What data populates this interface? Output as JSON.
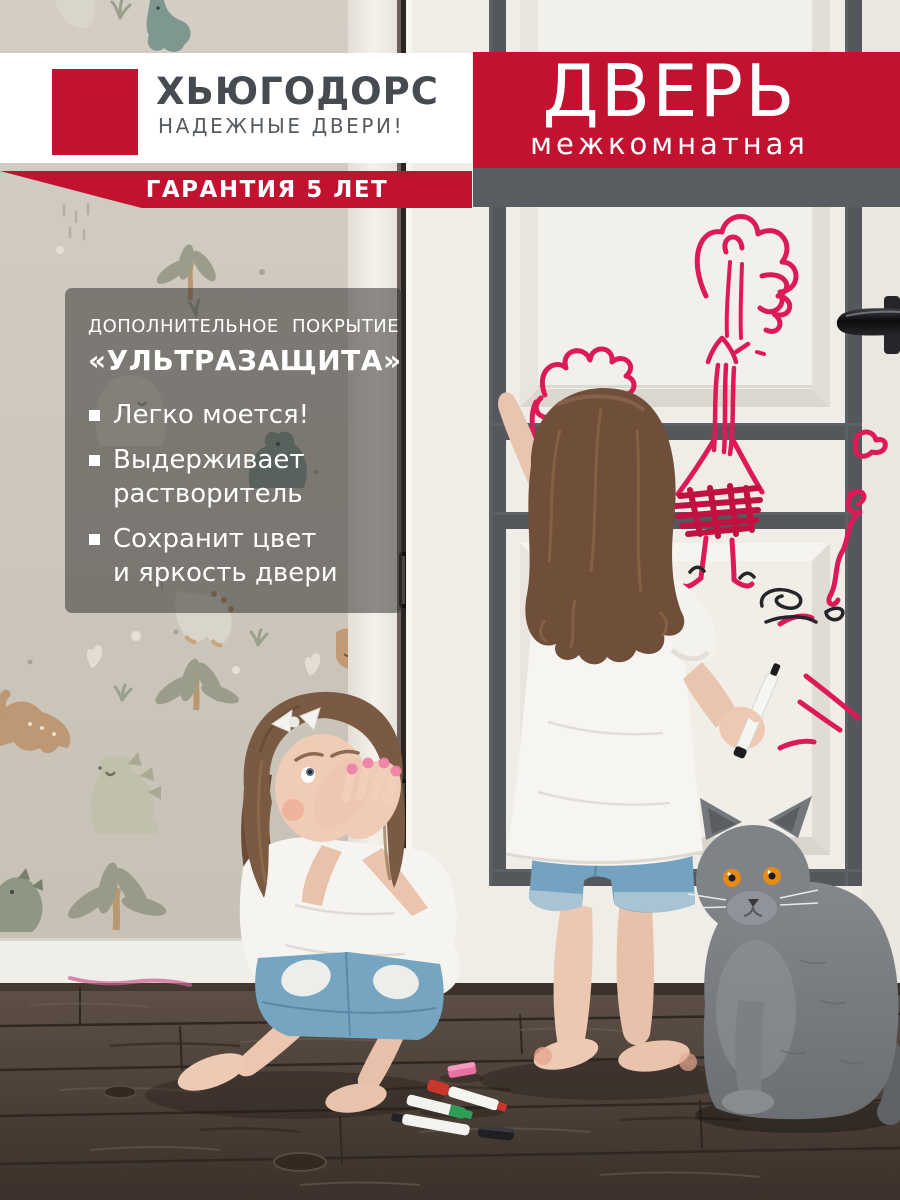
{
  "brand": {
    "name": "ХЬЮГОДОРС",
    "tagline": "НАДЕЖНЫЕ ДВЕРИ!",
    "guarantee": "ГАРАНТИЯ 5 ЛЕТ"
  },
  "product": {
    "title": "ДВЕРЬ",
    "subtitle": "межкомнатная"
  },
  "features": {
    "intro": "ДОПОЛНИТЕЛЬНОЕ ПОКРЫТИЕ",
    "coating": "«УЛЬТРАЗАЩИТА»",
    "items": [
      "Легко моется!",
      "Выдерживает\nрастворитель",
      "Сохранит цвет\nи яркость двери"
    ]
  },
  "colors": {
    "brand_red": "#C3122F",
    "dark_gray": "#595D61",
    "logo_text": "#464B51",
    "overlay_panel": "rgba(56,55,53,0.55)",
    "marker_pink": "#DC1A57",
    "door_cream": "#EFEDE6",
    "wallpaper": "#CBC5BB",
    "floor_brown": "#4A3E36"
  }
}
